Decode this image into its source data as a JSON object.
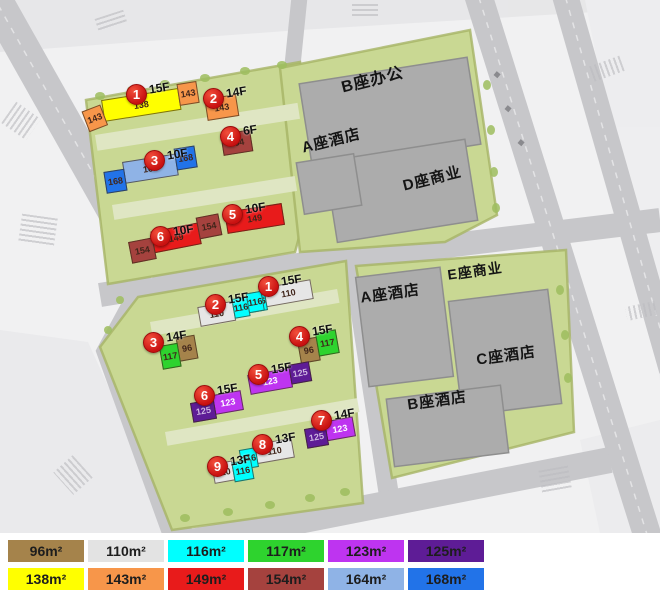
{
  "map": {
    "upper_block": {
      "buildings": [
        {
          "num": "1",
          "floors": "15F",
          "segments": [
            {
              "area": "143",
              "color": "#F7964A"
            },
            {
              "area": "138",
              "color": "#FFFF00"
            },
            {
              "area": "143",
              "color": "#F7964A"
            }
          ]
        },
        {
          "num": "2",
          "floors": "14F",
          "segments": [
            {
              "area": "143",
              "color": "#F7964A"
            }
          ]
        },
        {
          "num": "3",
          "floors": "10F",
          "segments": [
            {
              "area": "168",
              "color": "#2273E8"
            },
            {
              "area": "164",
              "color": "#8FB3E6"
            },
            {
              "area": "168",
              "color": "#2273E8"
            }
          ]
        },
        {
          "num": "4",
          "floors": "6F",
          "segments": [
            {
              "area": "154",
              "color": "#A5423E"
            }
          ]
        },
        {
          "num": "5",
          "floors": "10F",
          "segments": [
            {
              "area": "149",
              "color": "#E81B1B"
            }
          ]
        },
        {
          "num": "6",
          "floors": "10F",
          "segments": [
            {
              "area": "154",
              "color": "#A5423E"
            },
            {
              "area": "149",
              "color": "#E81B1B"
            },
            {
              "area": "154",
              "color": "#A5423E"
            }
          ]
        }
      ]
    },
    "lower_block": {
      "buildings": [
        {
          "num": "1",
          "floors": "15F",
          "segments": [
            {
              "area": "116",
              "color": "#00FFFF"
            },
            {
              "area": "110",
              "color": "#E6E6E6"
            }
          ]
        },
        {
          "num": "2",
          "floors": "15F",
          "segments": [
            {
              "area": "110",
              "color": "#E6E6E6"
            },
            {
              "area": "116",
              "color": "#00FFFF"
            },
            {
              "area": "116",
              "color": "#00FFFF"
            }
          ]
        },
        {
          "num": "3",
          "floors": "14F",
          "segments": [
            {
              "area": "117",
              "color": "#2ED32E"
            },
            {
              "area": "96",
              "color": "#A5834B"
            }
          ]
        },
        {
          "num": "4",
          "floors": "15F",
          "segments": [
            {
              "area": "96",
              "color": "#A5834B"
            },
            {
              "area": "117",
              "color": "#2ED32E"
            }
          ]
        },
        {
          "num": "5",
          "floors": "15F",
          "segments": [
            {
              "area": "123",
              "color": "#BE34F0"
            },
            {
              "area": "125",
              "color": "#5E1C96"
            }
          ]
        },
        {
          "num": "6",
          "floors": "15F",
          "segments": [
            {
              "area": "125",
              "color": "#5E1C96"
            },
            {
              "area": "123",
              "color": "#BE34F0"
            }
          ]
        },
        {
          "num": "7",
          "floors": "14F",
          "segments": [
            {
              "area": "125",
              "color": "#5E1C96"
            },
            {
              "area": "123",
              "color": "#BE34F0"
            }
          ]
        },
        {
          "num": "8",
          "floors": "13F",
          "segments": [
            {
              "area": "116",
              "color": "#00FFFF"
            },
            {
              "area": "110",
              "color": "#E6E6E6"
            }
          ]
        },
        {
          "num": "9",
          "floors": "13F",
          "segments": [
            {
              "area": "110",
              "color": "#E6E6E6"
            },
            {
              "area": "116",
              "color": "#00FFFF"
            }
          ]
        }
      ]
    },
    "commercial_labels": [
      "B座办公",
      "A座酒店",
      "D座商业",
      "E座商业",
      "A座酒店",
      "C座酒店",
      "B座酒店"
    ]
  },
  "legend": {
    "rows": [
      [
        {
          "label": "96m²",
          "color": "#A5834B"
        },
        {
          "label": "110m²",
          "color": "#E3E3E3"
        },
        {
          "label": "116m²",
          "color": "#00FFFF"
        },
        {
          "label": "117m²",
          "color": "#2ED32E"
        },
        {
          "label": "123m²",
          "color": "#BE34F0"
        },
        {
          "label": "125m²",
          "color": "#5E1C96"
        }
      ],
      [
        {
          "label": "138m²",
          "color": "#FFFF00"
        },
        {
          "label": "143m²",
          "color": "#F7964A"
        },
        {
          "label": "149m²",
          "color": "#E81B1B"
        },
        {
          "label": "154m²",
          "color": "#A5423E"
        },
        {
          "label": "164m²",
          "color": "#8FB3E6"
        },
        {
          "label": "168m²",
          "color": "#2273E8"
        }
      ]
    ]
  }
}
